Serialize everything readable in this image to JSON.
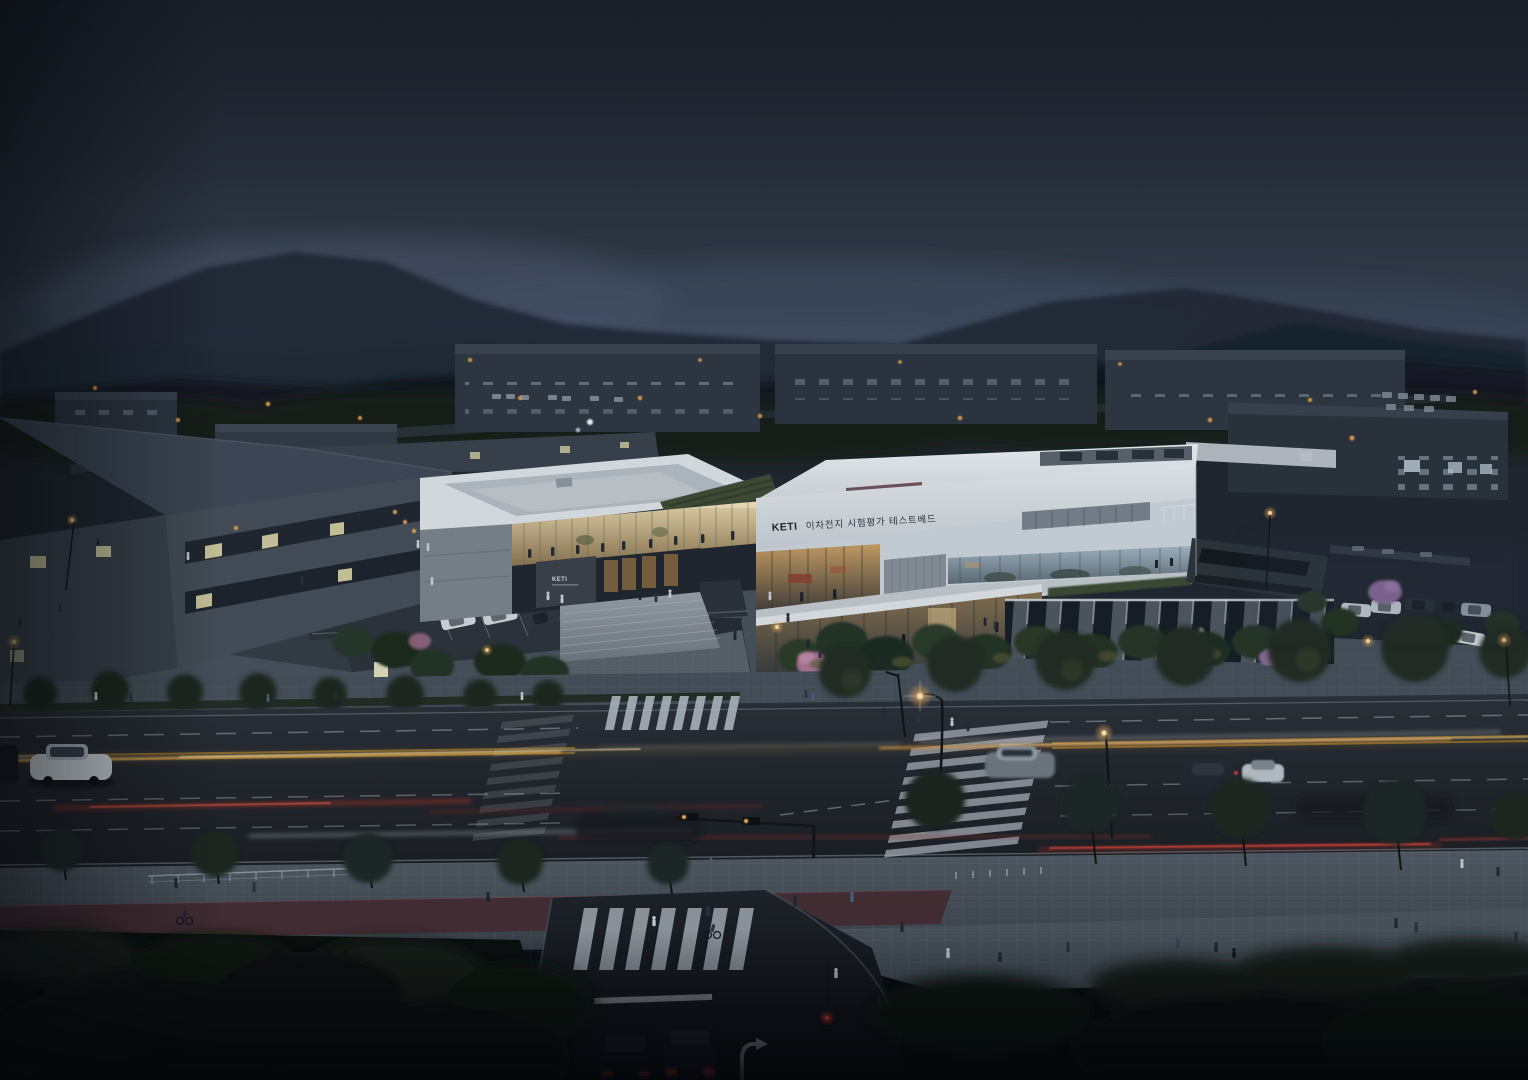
{
  "scene": {
    "title": "KETI secondary-battery test & evaluation testbed — aerial dusk architectural rendering",
    "setting": "Industrial park at dusk: misty mountains, white research campus, boulevard with light-trail traffic, crosswalks and pedestrians"
  },
  "signs": {
    "main": {
      "brand": "KETI",
      "label": "이차전지 시험평가 테스트베드"
    },
    "annex": {
      "brand": "KETI"
    }
  },
  "palette": {
    "sky_top": "#1f252e",
    "sky_horizon": "#49546a",
    "fog": "#4d5a70",
    "mountain": "#1d2530",
    "white_hi": "#e9edf0",
    "white_lo": "#c2cad2",
    "concrete": "#8a939c",
    "base_dark": "#272d34",
    "fin_dark": "#171c22",
    "glass_warm": "#e7d6ab",
    "glass_cool": "#a4b6c2",
    "green_roof": "#3f4b33",
    "tree_dark": "#1c251c",
    "blossom": "#a8738f",
    "blossom_purple": "#8d6d9c",
    "road": "#23282e",
    "sidewalk": "#4b545e",
    "bike_lane": "#42292d",
    "marking": "#aeb6be",
    "lane_yellow": "#e9b356",
    "trail_red": "#d8402f",
    "trail_white": "#dde3e8",
    "lamp": "#f2b45c",
    "signal_red": "#ff4438",
    "car_white": "#cfd5da",
    "car_dark": "#14181d",
    "sign_text": "#23272e"
  }
}
